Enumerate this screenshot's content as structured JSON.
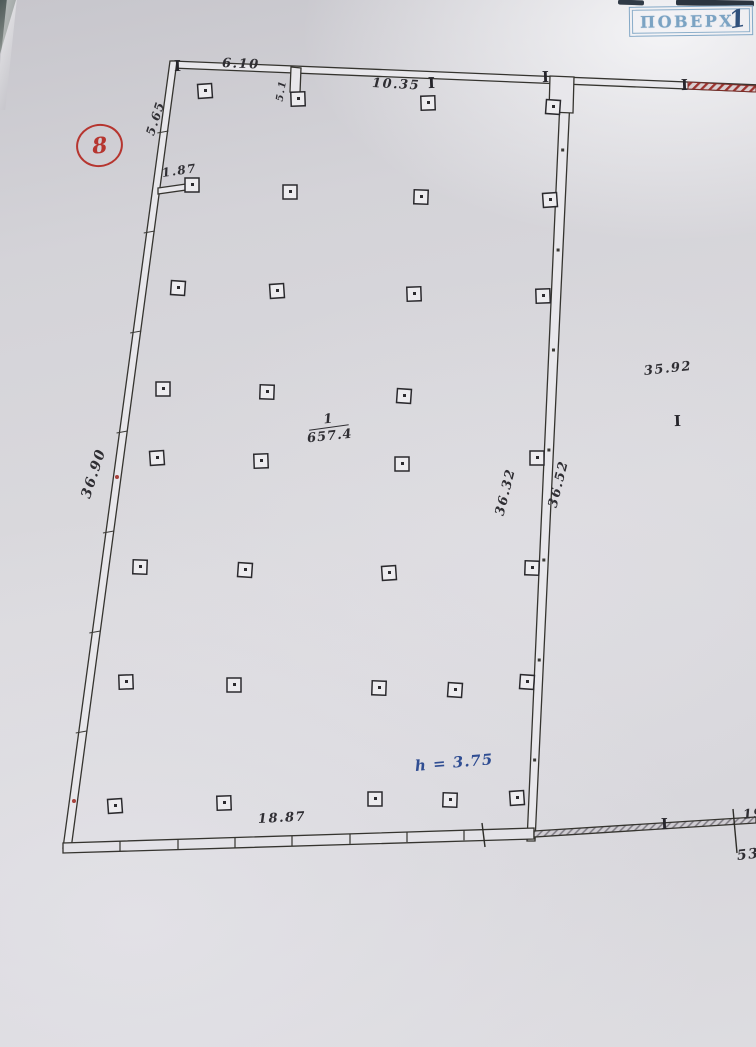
{
  "stamp": {
    "label": "ПОВЕРХ",
    "number": "1"
  },
  "plan": {
    "sheet_mark": "8",
    "column_marker": "I",
    "room": {
      "number": "1",
      "area": "657.4"
    },
    "height_note": "h = 3.75",
    "dims": {
      "top_left": "6.10",
      "top_stub": "5.1",
      "top_right": "10.35",
      "left_upper": "5.65",
      "left_stub": "1.87",
      "left_wall": "36.90",
      "mid_left": "36.32",
      "mid_right": "36.52",
      "right_area": "35.92",
      "bottom": "18.87",
      "edge_upper": "19",
      "edge_lower": "53"
    },
    "colors": {
      "ink": "#2f2e33",
      "red": "#b6352f",
      "blue_note": "#2f4d92",
      "stamp_blue": "#7ba3c3"
    }
  }
}
